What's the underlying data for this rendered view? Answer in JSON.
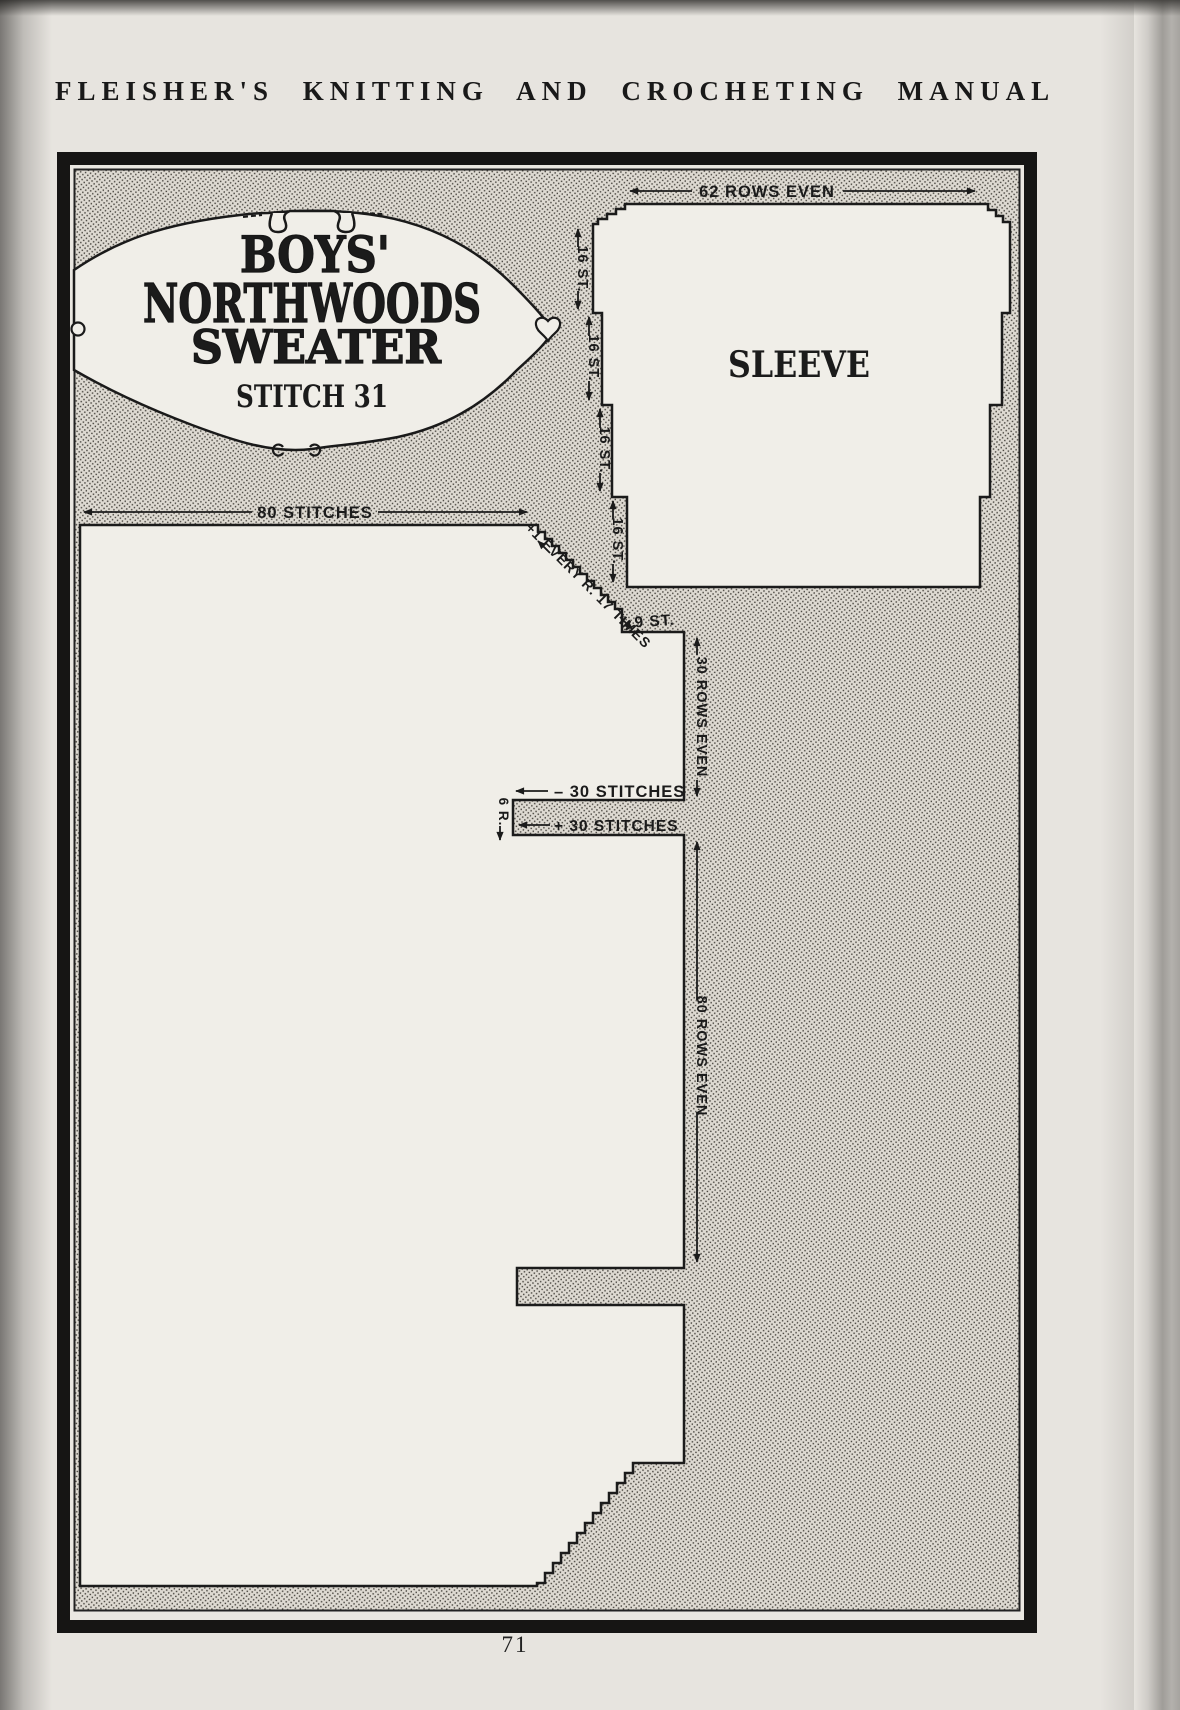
{
  "page": {
    "header": "FLEISHER'S KNITTING AND CROCHETING MANUAL",
    "page_number": "71"
  },
  "banner": {
    "title_line1": "BOYS'",
    "title_line2": "NORTHWOODS",
    "title_line3": "SWEATER",
    "subtitle": "STITCH 31"
  },
  "diagram": {
    "sleeve": {
      "label": "SLEEVE",
      "top_rows": "62 ROWS EVEN",
      "edge_steps": [
        "16 ST.",
        "16 ST.",
        "16 ST.",
        "16 ST."
      ]
    },
    "body": {
      "top_stitches": "80 STITCHES",
      "neck_decrease": "+1 EVERY R. 17 TIMES",
      "neck_stitches": "9 ST.",
      "upper_rows": "30 ROWS EVEN",
      "bind_off": "– 30 STITCHES",
      "cast_on": "+ 30 STITCHES",
      "slit_rows": "6 R.",
      "lower_rows": "80 ROWS EVEN"
    }
  },
  "colors": {
    "paper": "#e7e4df",
    "ink": "#1b1b1b",
    "piece_fill": "#f0eee8",
    "stipple_dot": "#47443e"
  }
}
